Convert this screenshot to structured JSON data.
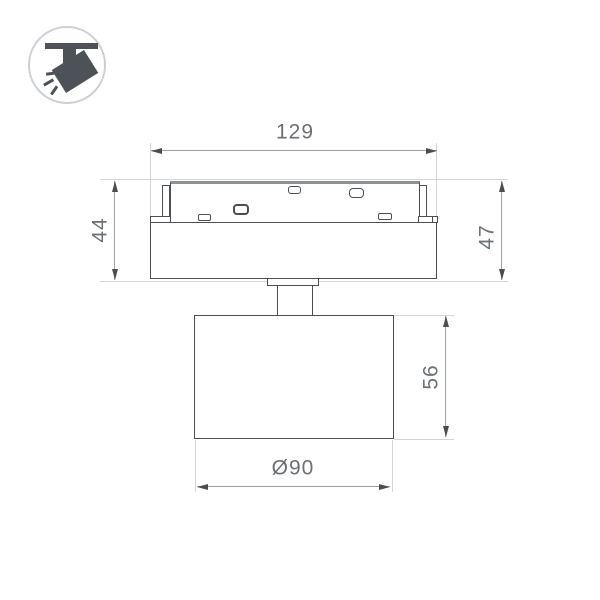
{
  "drawing": {
    "kind": "product dimension drawing",
    "subject": "track-mounted spotlight, side view",
    "dimensions": {
      "overall_width": "129",
      "height_left": "44",
      "height_right": "47",
      "head_height": "56",
      "head_diameter": "Ø90"
    },
    "icon": {
      "name": "ceiling-track-spotlight-icon"
    },
    "colors": {
      "outline": "#4a4e52",
      "dimension_line": "#9aa0a4",
      "extension_line": "#d3d6d8",
      "label_text": "#6b7074",
      "icon_fill": "#4c5257",
      "icon_circle_border": "#cdd0d3",
      "background": "#ffffff"
    }
  }
}
